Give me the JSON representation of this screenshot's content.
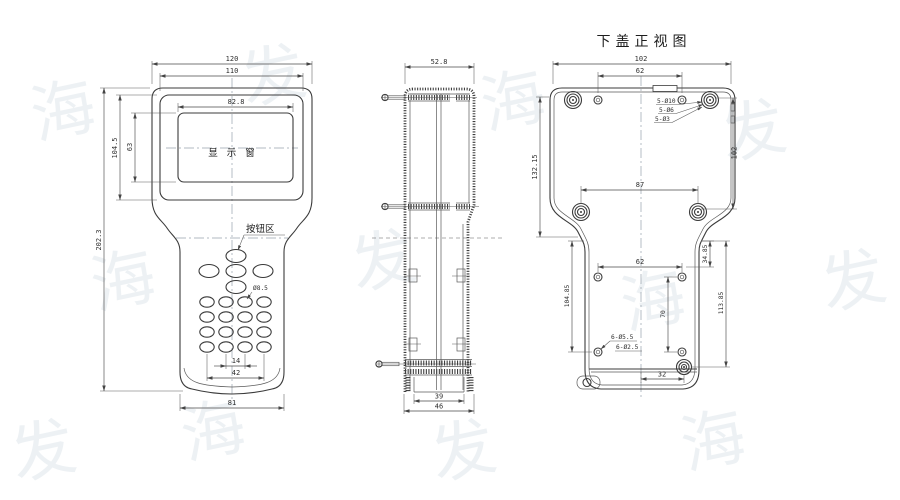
{
  "watermark": {
    "text": "海发",
    "color": "#adbecc"
  },
  "front_view": {
    "labels": {
      "display_window": "显示窗",
      "button_area": "按钮区"
    },
    "dims": {
      "overall_width": "120",
      "frame_width": "110",
      "window_width": "82.8",
      "window_height": "63",
      "frame_height": "104.5",
      "overall_height": "202.3",
      "button_diameter": "Ø8.5",
      "key_pitch": "14",
      "key_span": "42",
      "grip_width": "81"
    }
  },
  "side_view": {
    "dims": {
      "depth": "52.8",
      "battery_inner_width": "39",
      "battery_outer_width": "46"
    }
  },
  "bottom_cover_view": {
    "title": "下盖正视图",
    "dims": {
      "top_width": "102",
      "top_hole_span": "62",
      "left_height": "132.15",
      "right_height": "102",
      "waist_boss_span": "87",
      "mid_hole_span": "62",
      "upper_right_offset": "34.85",
      "left_boss_height": "104.85",
      "mid_hole_height": "70",
      "right_boss_height": "113.85",
      "bottom_boss_offset": "32"
    },
    "notes": {
      "corner_boss_outer": "5-Ø10",
      "corner_boss_mid": "5-Ø6",
      "corner_boss_hole": "5-Ø3",
      "inner_boss_outer": "6-Ø5.5",
      "inner_boss_hole": "6-Ø2.5"
    }
  }
}
